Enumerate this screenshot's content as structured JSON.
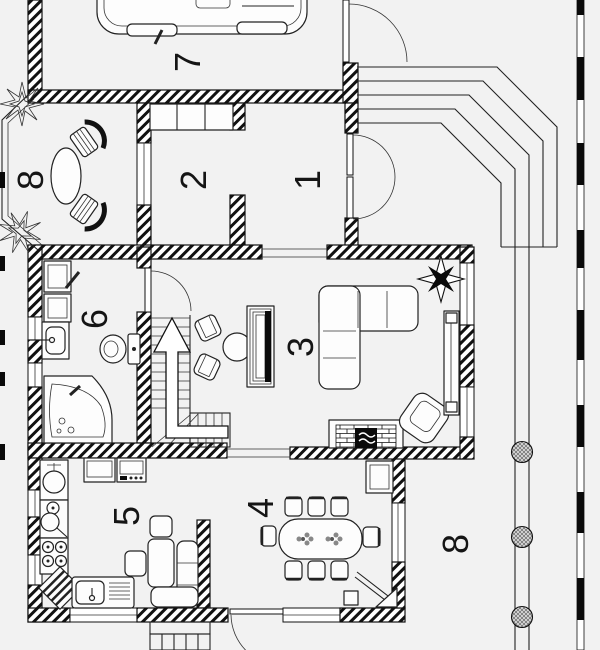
{
  "title": "floor-plan",
  "colors": {
    "background": "#f2f2f2",
    "line": "#111111",
    "wall": "#000000",
    "column_fill": "#777777"
  },
  "rooms": [
    {
      "id": "hall",
      "label": "1"
    },
    {
      "id": "room",
      "label": "2"
    },
    {
      "id": "living-room",
      "label": "3"
    },
    {
      "id": "dining-room",
      "label": "4"
    },
    {
      "id": "kitchen",
      "label": "5"
    },
    {
      "id": "bathroom",
      "label": "6"
    },
    {
      "id": "garage",
      "label": "7"
    },
    {
      "id": "veranda",
      "label": "8"
    },
    {
      "id": "terrace",
      "label": "8"
    }
  ]
}
